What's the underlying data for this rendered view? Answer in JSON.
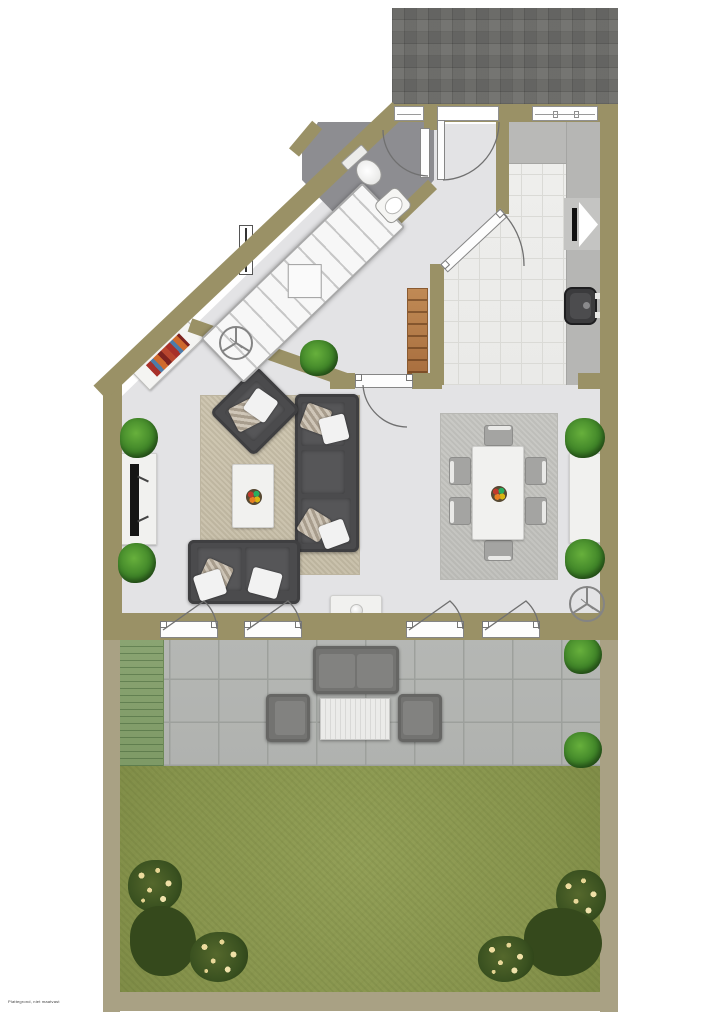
{
  "watermark": {
    "text": "Plattegrond, niet maatvast"
  },
  "floor_plan": {
    "type": "residential-ground-floor-top-down-plan",
    "palette": {
      "wall": "#9a9166",
      "garden_fence": "#a9a184",
      "interior_floor": "#e3e3e5",
      "bathroom_tile": "#8e8e92",
      "kitchen_tile": "#ededeb",
      "kitchen_counter": "#b8b8b6",
      "brick_driveway": "#a6a6a4",
      "terrace_paver": "#b5b7b4",
      "deck_strip": "#87a06f",
      "lawn": "#8f9c55",
      "living_rug": "#cdc5b0",
      "dining_rug": "#c7c7c3",
      "sofa": "#4b4b4d",
      "outdoor_furniture": "#7b7b79",
      "wood_cabinet": "#b97e4b",
      "plant_green": "#4c8c34",
      "flower_yellow": "#eddc9e",
      "flower_red": "#8c1622"
    },
    "front_outdoor": {
      "surface": "grey-brick-paving"
    },
    "rooms": [
      {
        "area": "hallway",
        "fixtures": [
          "front-door",
          "radiator",
          "wooden-shelf-cabinet",
          "interior-doors"
        ]
      },
      {
        "area": "bathroom",
        "fixtures": [
          "toilet",
          "washbasin",
          "door",
          "small-window"
        ]
      },
      {
        "area": "stairwell",
        "fixtures": [
          "winder-staircase"
        ]
      },
      {
        "area": "kitchen",
        "fixtures": [
          "l-shaped-counter",
          "sink",
          "appliance",
          "window",
          "tiled-floor"
        ]
      },
      {
        "area": "living-room",
        "fixtures": [
          "corner-sofa",
          "loveseat",
          "armchair",
          "coffee-table-with-fruit-bowl",
          "tv-sideboard",
          "tv",
          "bookshelf",
          "area-rug",
          "ceiling-fan-symbol",
          "potted-plants",
          "side-table-with-vase"
        ]
      },
      {
        "area": "dining-room",
        "fixtures": [
          "dining-table",
          "six-chairs",
          "fruit-bowl",
          "area-rug",
          "sideboard",
          "ceiling-fan-symbol",
          "potted-plants"
        ]
      }
    ],
    "back_outdoor": {
      "terrace": [
        "deck-strip",
        "outdoor-sofa",
        "outdoor-chair-left",
        "outdoor-chair-right",
        "slatted-coffee-table",
        "potted-plants"
      ],
      "garden": [
        "lawn",
        "flower-bushes-yellow",
        "flower-bushes-red"
      ]
    }
  }
}
